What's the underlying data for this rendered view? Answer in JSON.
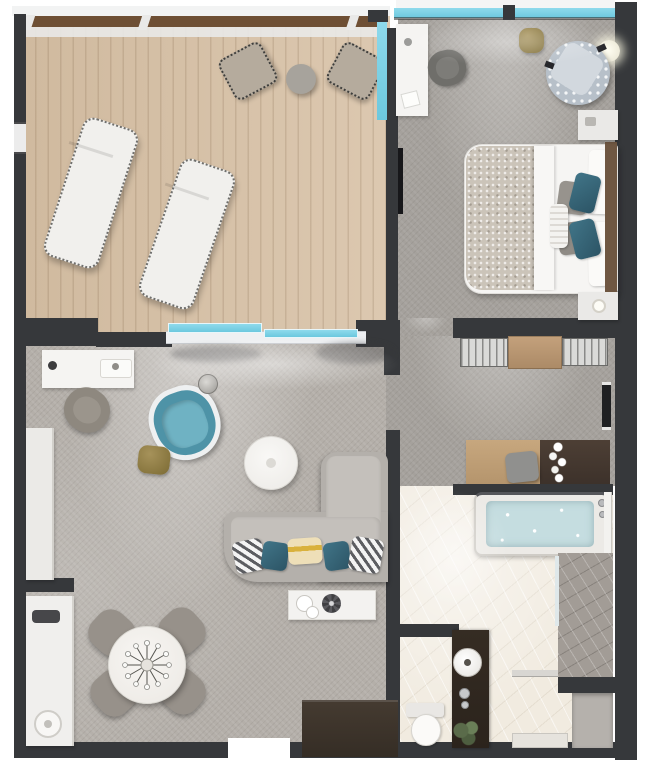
{
  "scene": {
    "type": "floor-plan",
    "description": "Top-down 3D rendered floor plan of a hotel suite: wooden balcony terrace with two sun loungers (top left), bedroom with king bed and desk (top right), living and dining room (bottom left), dressing corridor with wardrobes, vanity, bathtub, shower and washroom (right), entry at bottom.",
    "width_px": 646,
    "height_px": 767,
    "visible_text": []
  },
  "palette": {
    "wall": "#36383b",
    "deck_wood": "#d6c0a6",
    "rail_wood": "#6e4f34",
    "carpet_bedroom": "#a5a19c",
    "carpet_living": "#b4afa9",
    "marble_floor": "#f1ebe0",
    "glass_teal": "#7bd2e6",
    "armchair_teal": "#4e93a7",
    "pillow_teal": "#38697c",
    "brass_gold": "#8c7940",
    "sofa_gray": "#b4b0ab",
    "furniture_white": "#f5f4f2",
    "shower_tile": "#a29c96",
    "vanity_wood": "#bf9f78",
    "vanity_dark": "#463931",
    "bed_throw": "#cbc4b9",
    "headboard_wood": "#6f5742"
  },
  "labels": {
    "plan": "Suite floor plan",
    "balcony": "Balcony terrace with wood decking",
    "railing": "Balcony railing",
    "sun_lounger": "Sun lounger",
    "deck_chair": "Deck chair",
    "side_table": "Round side table",
    "bedroom": "Bedroom",
    "window": "Window",
    "sliding_door": "Sliding glass door",
    "desk": "Desk",
    "desk_chair": "Desk chair",
    "tv": "Wall-mounted TV",
    "ottoman": "Brass ottoman",
    "floor_lamp": "Floor lamp",
    "armchair": "Round tufted armchair",
    "bed": "King bed",
    "bed_throw": "Bed runner throw",
    "headboard": "Headboard",
    "nightstand": "Nightstand",
    "corridor": "Dressing corridor",
    "wardrobe": "Wardrobe unit",
    "mirror": "Wall mirror",
    "vanity": "Vanity counter",
    "stool": "Vanity stool",
    "flowers": "Vase of flowers",
    "bathtub": "Bathtub",
    "towel_rail": "Towel rail",
    "shower": "Walk-in shower",
    "washroom": "Washroom",
    "sink": "Round vessel sink",
    "toilet": "Toilet",
    "plant": "Plant",
    "living_room": "Living room",
    "sofa": "L-shaped sectional sofa",
    "throw_pillow": "Throw pillow",
    "coffee_table": "Round coffee table",
    "swivel_chair": "Teal swivel armchair",
    "bench": "Window bench",
    "minibar": "Minibar cabinet",
    "kettle": "Kettle",
    "counter": "Service counter",
    "dining_table": "Round dining table",
    "dining_chair": "Dining chair",
    "entry_cabinet": "Entry cabinet",
    "entry": "Entry threshold",
    "curtain": "Curtain shadow"
  }
}
